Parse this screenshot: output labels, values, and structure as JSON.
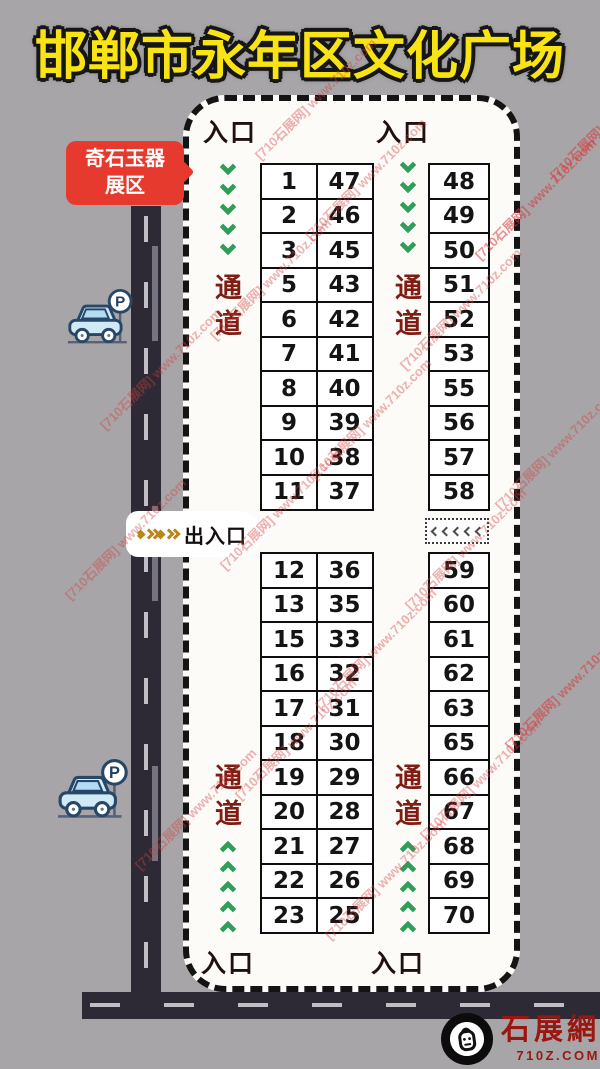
{
  "title": "邯郸市永年区文化广场",
  "area_label": {
    "line1": "奇石玉器",
    "line2": "展区"
  },
  "entrances": {
    "top_left": "入口",
    "top_right": "入口",
    "bottom_left": "入口",
    "bottom_right": "入口"
  },
  "gate_label": "出入口",
  "aisles": {
    "top_left": "通道",
    "top_middle": "通道",
    "bottom_left": "通道",
    "bottom_middle": "通道"
  },
  "flow": {
    "top_aisles": "down",
    "bottom_aisles": "up",
    "main_gate": "right",
    "side_gate": "left"
  },
  "parking_sign": "P",
  "stalls": {
    "top_left_rows": [
      [
        "1",
        "47"
      ],
      [
        "2",
        "46"
      ],
      [
        "3",
        "45"
      ],
      [
        "5",
        "43"
      ],
      [
        "6",
        "42"
      ],
      [
        "7",
        "41"
      ],
      [
        "8",
        "40"
      ],
      [
        "9",
        "39"
      ],
      [
        "10",
        "38"
      ],
      [
        "11",
        "37"
      ]
    ],
    "top_right_rows": [
      [
        "48"
      ],
      [
        "49"
      ],
      [
        "50"
      ],
      [
        "51"
      ],
      [
        "52"
      ],
      [
        "53"
      ],
      [
        "55"
      ],
      [
        "56"
      ],
      [
        "57"
      ],
      [
        "58"
      ]
    ],
    "bottom_left_rows": [
      [
        "12",
        "36"
      ],
      [
        "13",
        "35"
      ],
      [
        "15",
        "33"
      ],
      [
        "16",
        "32"
      ],
      [
        "17",
        "31"
      ],
      [
        "18",
        "30"
      ],
      [
        "19",
        "29"
      ],
      [
        "20",
        "28"
      ],
      [
        "21",
        "27"
      ],
      [
        "22",
        "26"
      ],
      [
        "23",
        "25"
      ]
    ],
    "bottom_right_rows": [
      [
        "59"
      ],
      [
        "60"
      ],
      [
        "61"
      ],
      [
        "62"
      ],
      [
        "63"
      ],
      [
        "65"
      ],
      [
        "66"
      ],
      [
        "67"
      ],
      [
        "68"
      ],
      [
        "69"
      ],
      [
        "70"
      ]
    ]
  },
  "watermark": {
    "text": "[710石展网] www.710z.com"
  },
  "logo": {
    "site_name": "石展網",
    "site_url": "710Z.COM"
  },
  "colors": {
    "background": "#a7a5a7",
    "title_yellow": "#f8e414",
    "badge_red": "#e73a2e",
    "aisle_text_red": "#7e1d13",
    "arrow_green": "#2f9e59",
    "gate_gold": "#b9861c",
    "road_dark": "#2d2a35",
    "watermark_red": "#d53e3e",
    "logo_red": "#9c150f"
  }
}
